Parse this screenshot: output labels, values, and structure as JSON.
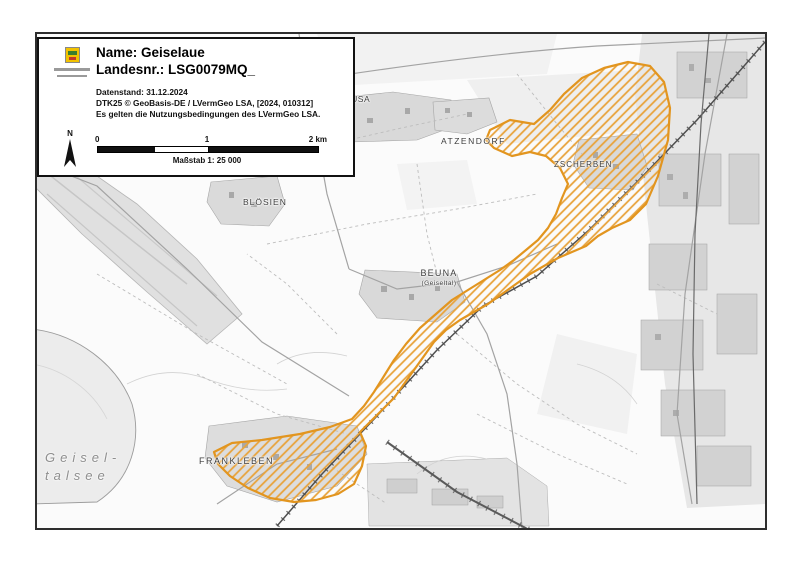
{
  "info_box": {
    "title_name": "Name: Geiselaue",
    "title_number": "Landesnr.: LSG0079MQ_",
    "meta_lines": [
      "Datenstand: 31.12.2024",
      "DTK25 © GeoBasis-DE / LVermGeo LSA, [2024, 010312]",
      "Es gelten die Nutzungsbedingungen des LVermGeo LSA."
    ],
    "north_label": "N",
    "scale": {
      "tick0": "0",
      "tick1": "1",
      "tick2": "2 km",
      "caption": "Maßstab 1: 25 000"
    }
  },
  "map": {
    "area_color": "#E8A33C",
    "area_border_color": "#E2951F",
    "labels": [
      {
        "id": "geusa",
        "text": "EUSA"
      },
      {
        "id": "atzendorf",
        "text": "ATZENDORF"
      },
      {
        "id": "zscherben",
        "text": "ZSCHERBEN"
      },
      {
        "id": "bloesien",
        "text": "BLÖSIEN"
      },
      {
        "id": "beuna",
        "text": "BEUNA"
      },
      {
        "id": "beuna-sub",
        "text": "(Geiseltal)"
      },
      {
        "id": "frankleben",
        "text": "FRANKLEBEN"
      },
      {
        "id": "geiseltalsee-line1",
        "text": "Geisel-"
      },
      {
        "id": "geiseltalsee-line2",
        "text": "talsee"
      }
    ]
  }
}
